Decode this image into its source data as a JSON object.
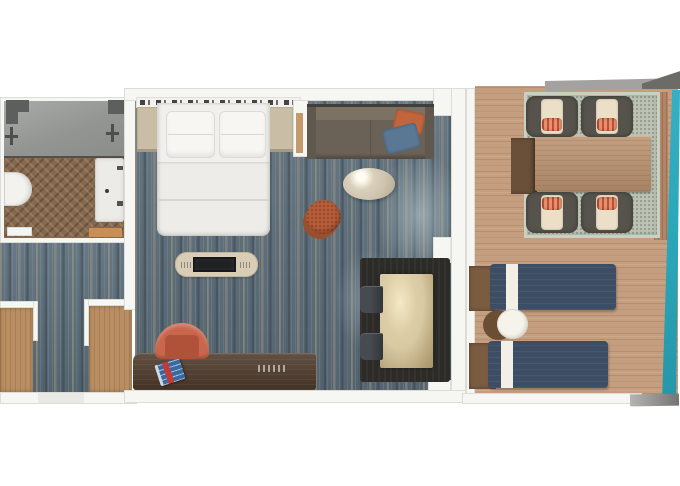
{
  "meta": {
    "title": "Cruise stateroom floor plan with private balcony (3D top-down render)",
    "visible_text": "none"
  },
  "colors": {
    "canvas_bg": "#ffffff",
    "wall": "#f6f6f3",
    "wall_line": "#dcdcd8",
    "carpet": "#5e707c",
    "tile": "#9b9d9b",
    "bath_wood": "#86684c",
    "bath_mat": "#c98e54",
    "closet_wood": "#b98e62",
    "linen": "#f1f0ed",
    "nightstand": "#cabda5",
    "headboard_dash": "#45443f",
    "sofa": "#6b6257",
    "pillow_orange": "#c2653c",
    "pillow_blue": "#5a7894",
    "coffee_table": "#cdc3ae",
    "ottoman": "#b65e3a",
    "console": "#d9ceb5",
    "tv": "#202124",
    "desk": "#513d2d",
    "desk_chair": "#c9664c",
    "book_blue": "#3a68a0",
    "book_red": "#c23b36",
    "dining_mat": "#2c2b27",
    "dining_table": "#d8c9a4",
    "dining_chair": "#464b50",
    "deck": "#c49e7f",
    "rug": "#bcc3b5",
    "patio_table": "#bb9371",
    "bench": "#6b5039",
    "patio_chair": "#55534b",
    "cushion": "#ecdfc8",
    "patio_pillow": "#e2926f",
    "patio_pillow_stripe": "#c24f33",
    "lounger": "#3d4d63",
    "lounger_stripe": "#f3efe6",
    "headrest": "#7a5c41",
    "side_table": "#f6f3ea",
    "side_table_shadow": "#6b4f35",
    "sea_teal": "#2ba7ba",
    "gray_band": "#a3a2a0",
    "dark_wedge": "#6c6b65"
  },
  "rooms": {
    "bathroom": {
      "name": "Bathroom",
      "items": [
        "walk-in shower",
        "shower valve left",
        "shower valve right",
        "toilet",
        "vanity sink",
        "towel rails",
        "herringbone wood floor",
        "bath mat",
        "door threshold"
      ]
    },
    "entry": {
      "name": "Entry hall",
      "items": [
        "wardrobe left",
        "wardrobe right",
        "carpeted corridor",
        "entry door"
      ]
    },
    "bedroom": {
      "name": "Main cabin",
      "items": [
        "headboard accent wall",
        "nightstand left",
        "king bed with two pillows",
        "nightstand right",
        "sofa with orange and blue throw pillows",
        "oval coffee table",
        "round ottoman pouf",
        "media console with TV",
        "writing desk with magazine",
        "desk chair",
        "dining table for two on dark mat",
        "two dining chairs",
        "patterned blue carpet",
        "balcony door threshold"
      ]
    },
    "balcony": {
      "name": "Balcony",
      "items": [
        "wood deck",
        "outdoor rug",
        "dining table",
        "wood bench end",
        "four cushioned patio chairs with coral pillows",
        "two navy sun loungers",
        "round side table",
        "teal glass railing",
        "hull edge"
      ]
    }
  }
}
